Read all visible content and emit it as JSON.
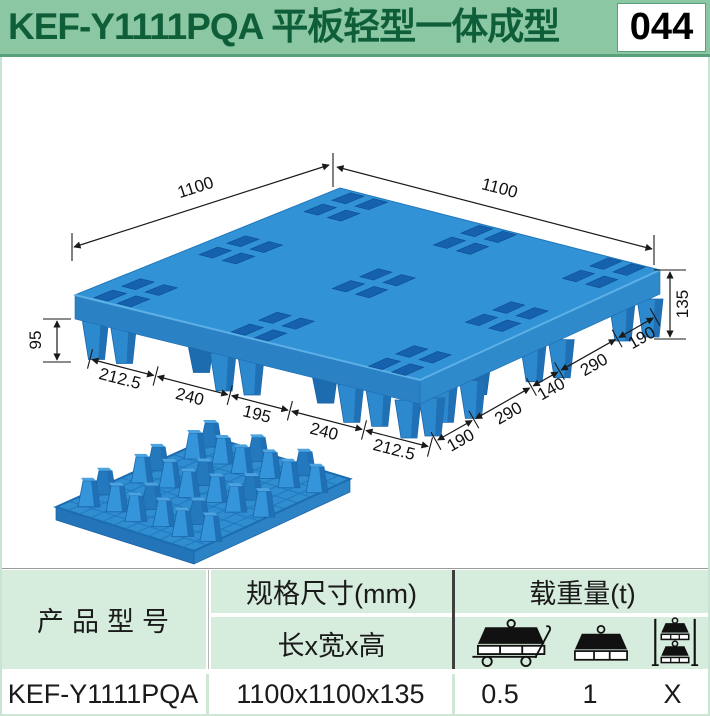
{
  "header": {
    "title": "KEF-Y1111PQA 平板轻型一体成型",
    "page_number": "044"
  },
  "drawing": {
    "top_left_length": "1100",
    "top_right_length": "1100",
    "total_height": "135",
    "foot_height": "95",
    "front_left_segments": [
      "212.5",
      "240",
      "195",
      "240",
      "212.5"
    ],
    "front_right_segments": [
      "190",
      "290",
      "140",
      "290",
      "190"
    ]
  },
  "table": {
    "product_model_header": "产品型号",
    "spec_header": "规格尺寸(mm)",
    "spec_sub_header": "长x宽x高",
    "load_header": "载重量(t)",
    "load_icons": [
      "dynamic-load",
      "static-load",
      "rack-load"
    ],
    "row": {
      "model": "KEF-Y1111PQA",
      "dimensions": "1100x1100x135",
      "dynamic_load": "0.5",
      "static_load": "1",
      "rack_load": "X"
    }
  },
  "colors": {
    "header_bg": "#8cc7a3",
    "header_text": "#0f5e3a",
    "header_accent": "#58a17c",
    "table_header_bg": "#d6ecdc",
    "table_divider_green": "#cfe8d6",
    "pallet_blue": "#3193d6",
    "pallet_face_left": "#2a82c5",
    "pallet_face_right": "#2e8acb",
    "pallet_hole_blue": "#1661ae",
    "pallet_foot_blue": "#2d89cd",
    "pallet_foot_shade": "#2070b5",
    "dimension_line": "#1a1a1a"
  }
}
